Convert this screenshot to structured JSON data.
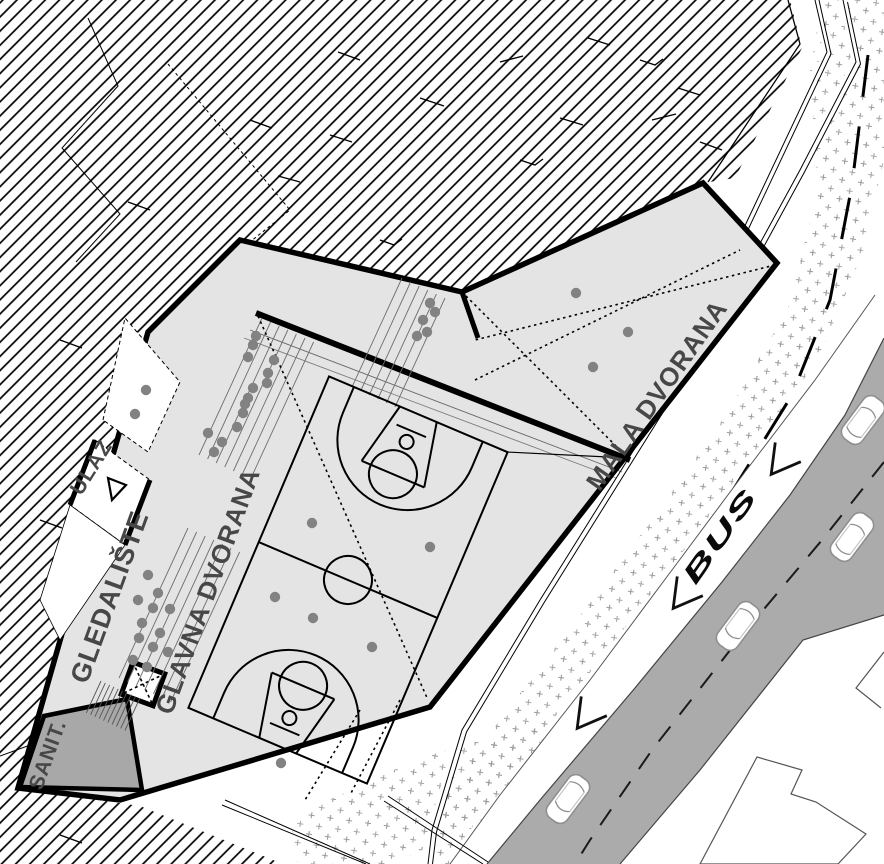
{
  "title": "Sports hall site plan",
  "labels": {
    "main_hall": "GLAVNA DVORANA",
    "small_hall": "MALA DVORANA",
    "stands": "GLEDALIŠTE",
    "entrance": "ULAZ",
    "sanitary": "SANIT.",
    "bus_lane": "BUS"
  },
  "colors": {
    "building_fill": "#e4e4e4",
    "sanitary_fill": "#a8a8a8",
    "road_fill": "#ababab",
    "dot_color": "#828282",
    "label_color": "#474747",
    "line_color": "#000000",
    "car_stroke": "#8f8f8f"
  },
  "features": {
    "basketball_court": "main hall court markings",
    "cars_on_road": 4,
    "elevator": "x-box symbol",
    "stairs": "tread hatch",
    "terrain": "diagonal hatch",
    "planting": "cross stipple"
  }
}
